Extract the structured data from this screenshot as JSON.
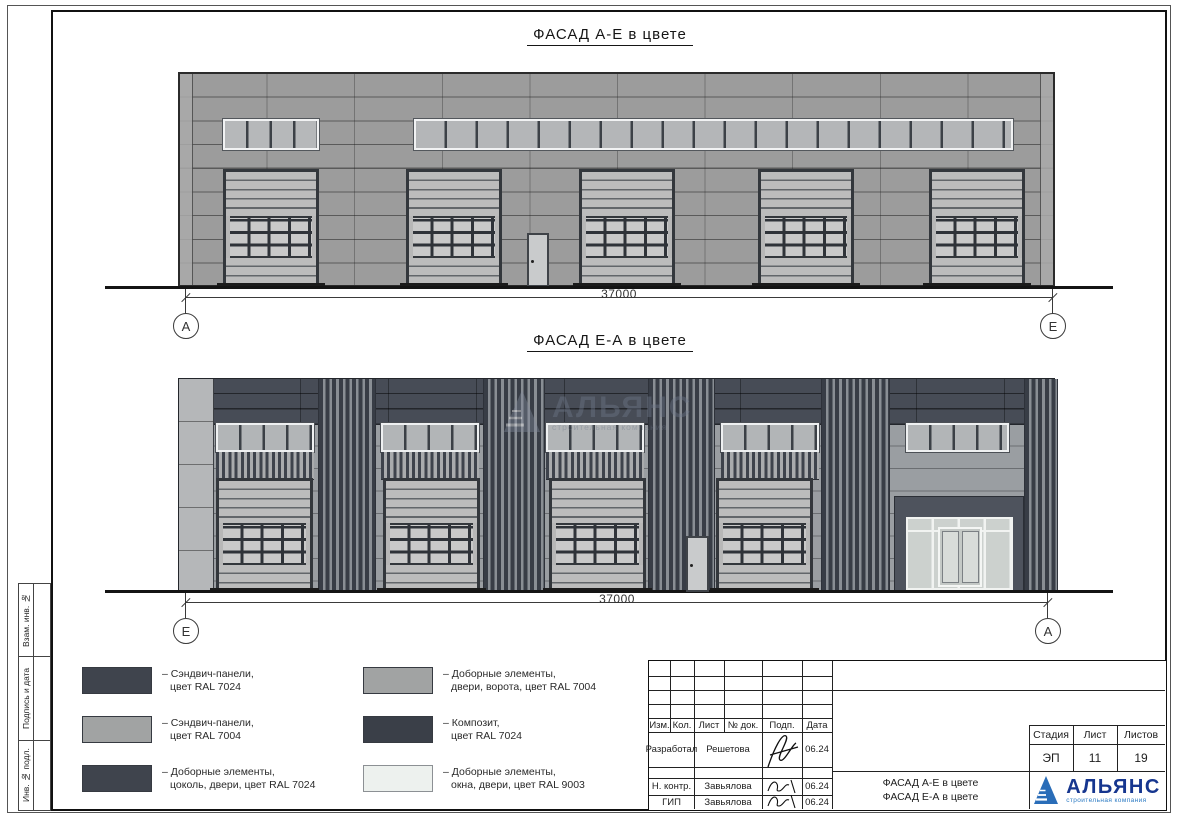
{
  "margin": {
    "labels": [
      "Взам. инв. №",
      "Подпись и дата",
      "Инв. № подл."
    ]
  },
  "facade1": {
    "title": "ФАСАД А-Е в цвете",
    "dim": "37000",
    "axis_left": "А",
    "axis_right": "Е"
  },
  "facade2": {
    "title": "ФАСАД Е-А в цвете",
    "dim": "37000",
    "axis_left": "Е",
    "axis_right": "А"
  },
  "watermark": {
    "name": "АЛЬЯНС",
    "subtitle": "строительная компания"
  },
  "legend": {
    "items": [
      {
        "color": "#3f444d",
        "line1": "– Сэндвич-панели,",
        "line2": "цвет RAL 7024"
      },
      {
        "color": "#a1a3a3",
        "line1": "– Сэндвич-панели,",
        "line2": "цвет RAL 7004"
      },
      {
        "color": "#3f444d",
        "line1": "– Доборные элементы,",
        "line2": "цоколь, двери, цвет RAL 7024"
      },
      {
        "color": "#a1a3a3",
        "line1": "– Доборные элементы,",
        "line2": "двери, ворота, цвет RAL 7004"
      },
      {
        "color": "#3a3f48",
        "line1": "– Композит,",
        "line2": "цвет RAL 7024"
      },
      {
        "color": "#edf1ee",
        "line1": "– Доборные элементы,",
        "line2": "окна, двери, цвет RAL 9003"
      }
    ]
  },
  "titleblock": {
    "header": [
      "Изм.",
      "Кол.",
      "Лист",
      "№ док.",
      "Подп.",
      "Дата"
    ],
    "rows": [
      {
        "role": "Разработал",
        "name": "Решетова",
        "date": "06.24"
      },
      {
        "role": "Н. контр.",
        "name": "Завьялова",
        "date": "06.24"
      },
      {
        "role": "ГИП",
        "name": "Завьялова",
        "date": "06.24"
      }
    ],
    "stage_label": "Стадия",
    "sheet_label": "Лист",
    "sheets_label": "Листов",
    "stage": "ЭП",
    "sheet": "11",
    "sheets": "19",
    "doc_line1": "ФАСАД А-Е в цвете",
    "doc_line2": "ФАСАД Е-А в цвете",
    "company": "АЛЬЯНС",
    "company_sub": "строительная компания"
  },
  "colors": {
    "ral7024": "#3f444d",
    "ral7004": "#a1a3a3",
    "ral9003": "#edf1ee",
    "logo_blue": "#16368f",
    "logo_light_blue": "#2e7cc4"
  }
}
